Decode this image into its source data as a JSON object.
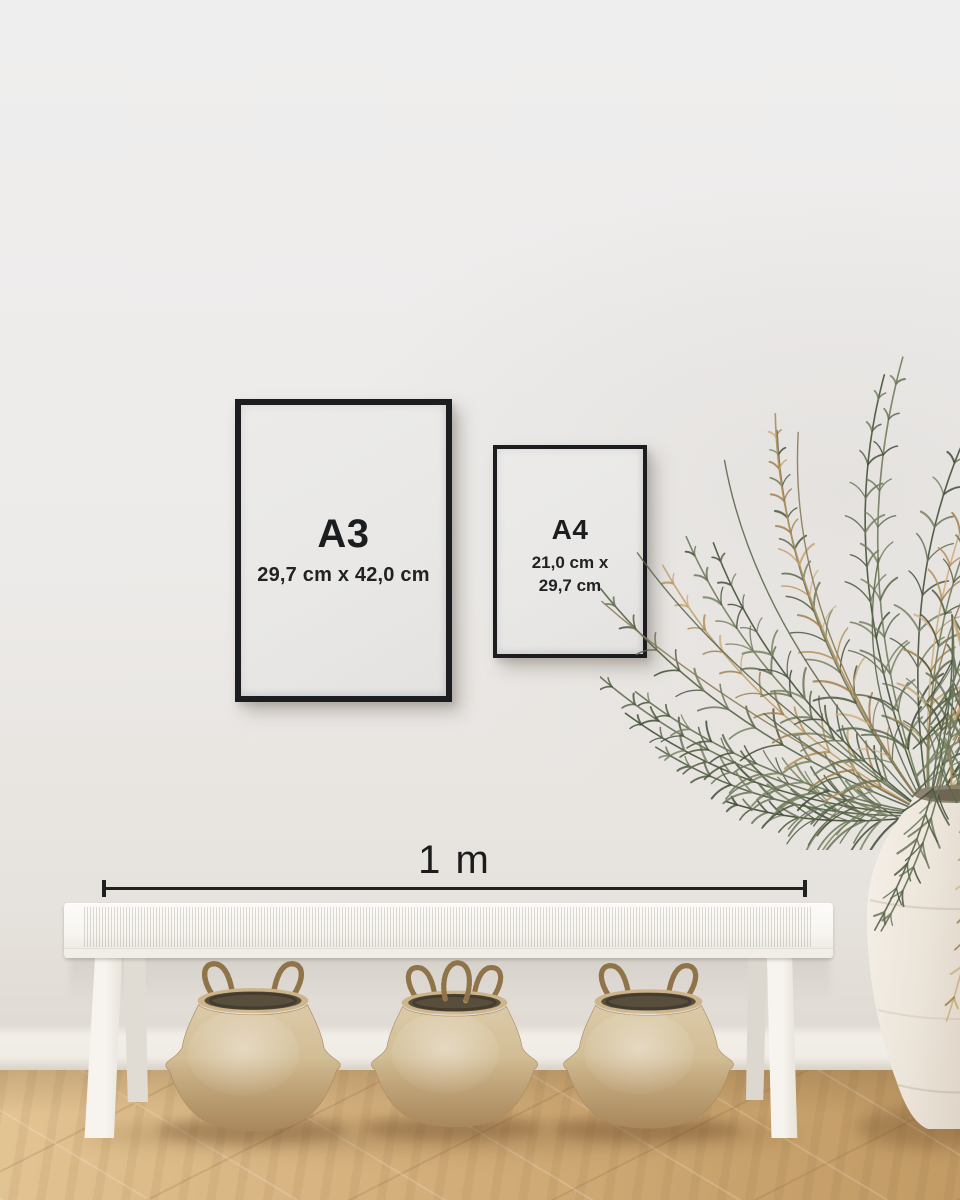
{
  "frames": {
    "a3": {
      "label": "A3",
      "dimensions": "29,7 cm x 42,0 cm"
    },
    "a4": {
      "label": "A4",
      "dimensions_line1": "21,0 cm x",
      "dimensions_line2": "29,7 cm"
    }
  },
  "scale_bar": {
    "label": "1 m"
  },
  "colors": {
    "frame": "#1b1d21",
    "frame_text": "#1c1d1f",
    "paper": "#e9e8e6",
    "wall": "#eeedec",
    "baseboard": "#f0ece5",
    "floor_light": "#e3c493",
    "floor_mid": "#d2ad79",
    "floor_dark": "#c19a64",
    "bench": "#f8f6f2",
    "basket_light": "#dccaa8",
    "basket_dark": "#a8875b",
    "plant_green": "#5c684e",
    "plant_tan": "#b3905c",
    "vase": "#ece5da",
    "scale_line": "#212121"
  },
  "objects": {
    "left_frame": "a3-poster-frame",
    "right_frame": "a4-poster-frame",
    "seat": "white-woven-bench",
    "under_bench": "seagrass-belly-basket-x3",
    "right_side": "dried-palm-in-white-urn"
  }
}
